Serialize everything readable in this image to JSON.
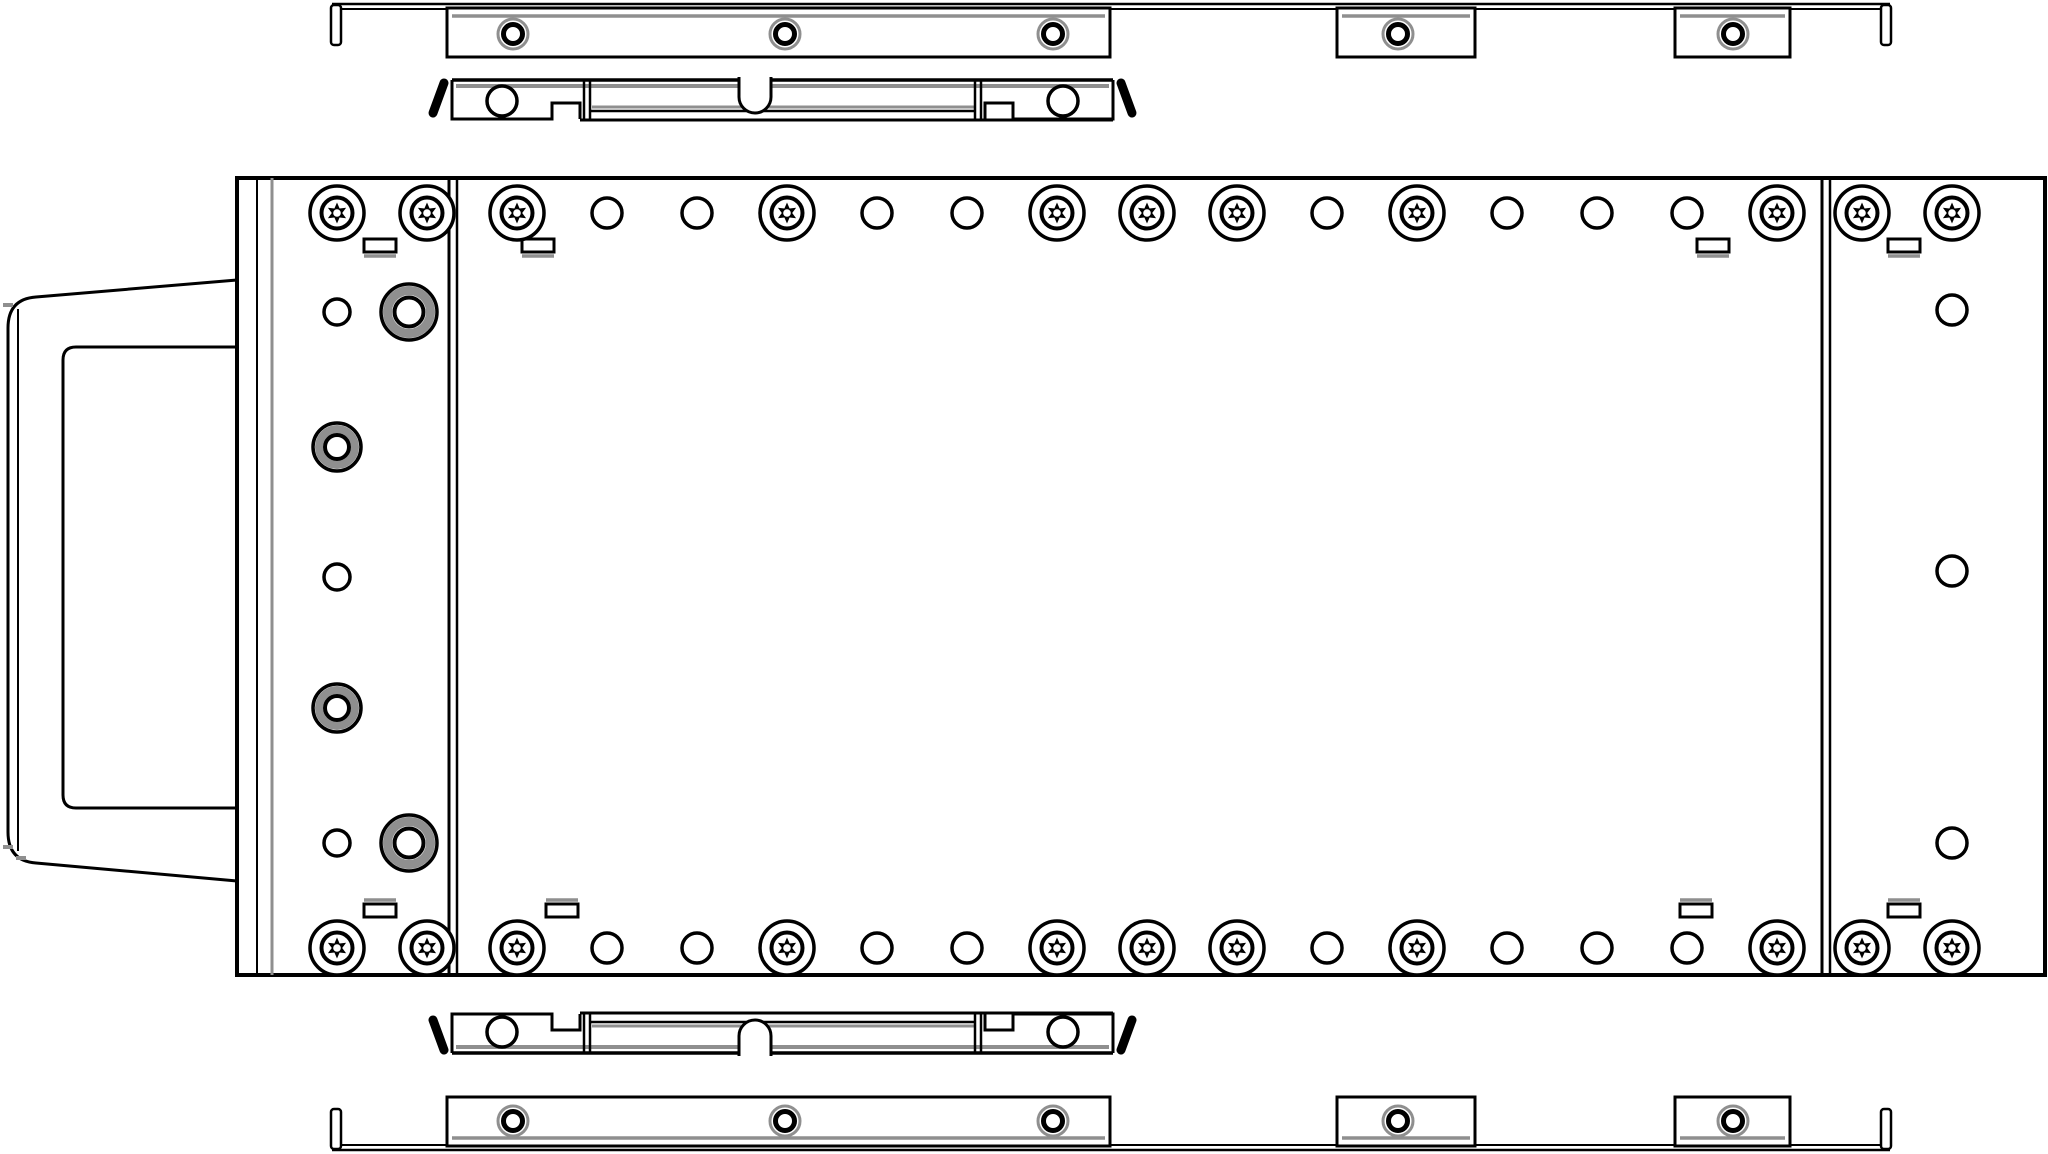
{
  "drawing": {
    "title": "hot-swap-drive-tray-exploded-side-view",
    "description": "Black-and-white engineering line drawing of a server drive tray/carrier body with handle, two latch brackets and two grommet mounting rails shown exploded above and below",
    "canvas": {
      "w": 2048,
      "h": 1154
    },
    "colors": {
      "line": "#000000",
      "gray": "#8f8f8f",
      "bg": "#ffffff"
    }
  },
  "parts": [
    {
      "name": "carrier-handle",
      "shapes": [
        {
          "t": "p",
          "d": "M237,280 L36,297 Q8,299 8,328 L8,832 Q8,861 36,863 L237,881",
          "sw": 3
        },
        {
          "t": "v",
          "x": 18,
          "y1": 309,
          "y2": 851,
          "sw": 2
        },
        {
          "t": "p",
          "d": "M237,347 L76,347 Q63,347 63,360 L63,795 Q63,808 76,808 L237,808",
          "sw": 3
        },
        {
          "t": "r",
          "x": 3,
          "y": 303,
          "w": 10,
          "h": 4,
          "sw": 0,
          "f": "#8f8f8f"
        },
        {
          "t": "r",
          "x": 3,
          "y": 845,
          "w": 10,
          "h": 4,
          "sw": 0,
          "f": "#8f8f8f"
        },
        {
          "t": "r",
          "x": 16,
          "y": 856,
          "w": 10,
          "h": 4,
          "sw": 0,
          "f": "#8f8f8f"
        }
      ]
    },
    {
      "name": "tray-body",
      "shapes": [
        {
          "t": "r",
          "x": 237,
          "y": 178,
          "w": 1808,
          "h": 797,
          "sw": 4,
          "f": "#ffffff"
        },
        {
          "t": "v",
          "x": 257,
          "y1": 178,
          "y2": 975,
          "sw": 2
        },
        {
          "t": "v",
          "x": 272,
          "y1": 178,
          "y2": 975,
          "sw": 3,
          "c": "y"
        },
        {
          "t": "v",
          "x": 449,
          "y1": 178,
          "y2": 975,
          "sw": 3
        },
        {
          "t": "v",
          "x": 457,
          "y1": 178,
          "y2": 975,
          "sw": 2.5
        },
        {
          "t": "v",
          "x": 1822,
          "y1": 178,
          "y2": 975,
          "sw": 3
        },
        {
          "t": "v",
          "x": 1830,
          "y1": 178,
          "y2": 975,
          "sw": 2.5
        },
        {
          "t": "s",
          "x": 364,
          "y": 239,
          "side": "b"
        },
        {
          "t": "s",
          "x": 522,
          "y": 239,
          "side": "b"
        },
        {
          "t": "s",
          "x": 1697,
          "y": 239,
          "side": "b"
        },
        {
          "t": "s",
          "x": 1888,
          "y": 239,
          "side": "b"
        },
        {
          "t": "s",
          "x": 364,
          "y": 904,
          "side": "t"
        },
        {
          "t": "s",
          "x": 546,
          "y": 904,
          "side": "t"
        },
        {
          "t": "s",
          "x": 1680,
          "y": 904,
          "side": "t"
        },
        {
          "t": "s",
          "x": 1888,
          "y": 904,
          "side": "t"
        },
        {
          "t": "t",
          "cx": 517,
          "cy": 213
        },
        {
          "t": "c",
          "cx": 607,
          "cy": 213,
          "r": 15,
          "sw": 3.5
        },
        {
          "t": "c",
          "cx": 697,
          "cy": 213,
          "r": 15,
          "sw": 3.5
        },
        {
          "t": "t",
          "cx": 787,
          "cy": 213
        },
        {
          "t": "c",
          "cx": 877,
          "cy": 213,
          "r": 15,
          "sw": 3.5
        },
        {
          "t": "c",
          "cx": 967,
          "cy": 213,
          "r": 15,
          "sw": 3.5
        },
        {
          "t": "t",
          "cx": 1057,
          "cy": 213
        },
        {
          "t": "t",
          "cx": 1147,
          "cy": 213
        },
        {
          "t": "t",
          "cx": 1237,
          "cy": 213
        },
        {
          "t": "c",
          "cx": 1327,
          "cy": 213,
          "r": 15,
          "sw": 3.5
        },
        {
          "t": "t",
          "cx": 1417,
          "cy": 213
        },
        {
          "t": "c",
          "cx": 1507,
          "cy": 213,
          "r": 15,
          "sw": 3.5
        },
        {
          "t": "c",
          "cx": 1597,
          "cy": 213,
          "r": 15,
          "sw": 3.5
        },
        {
          "t": "c",
          "cx": 1687,
          "cy": 213,
          "r": 15,
          "sw": 3.5
        },
        {
          "t": "t",
          "cx": 1777,
          "cy": 213
        },
        {
          "t": "t",
          "cx": 517,
          "cy": 948
        },
        {
          "t": "c",
          "cx": 607,
          "cy": 948,
          "r": 15,
          "sw": 3.5
        },
        {
          "t": "c",
          "cx": 697,
          "cy": 948,
          "r": 15,
          "sw": 3.5
        },
        {
          "t": "t",
          "cx": 787,
          "cy": 948
        },
        {
          "t": "c",
          "cx": 877,
          "cy": 948,
          "r": 15,
          "sw": 3.5
        },
        {
          "t": "c",
          "cx": 967,
          "cy": 948,
          "r": 15,
          "sw": 3.5
        },
        {
          "t": "t",
          "cx": 1057,
          "cy": 948
        },
        {
          "t": "t",
          "cx": 1147,
          "cy": 948
        },
        {
          "t": "t",
          "cx": 1237,
          "cy": 948
        },
        {
          "t": "c",
          "cx": 1327,
          "cy": 948,
          "r": 15,
          "sw": 3.5
        },
        {
          "t": "t",
          "cx": 1417,
          "cy": 948
        },
        {
          "t": "c",
          "cx": 1507,
          "cy": 948,
          "r": 15,
          "sw": 3.5
        },
        {
          "t": "c",
          "cx": 1597,
          "cy": 948,
          "r": 15,
          "sw": 3.5
        },
        {
          "t": "c",
          "cx": 1687,
          "cy": 948,
          "r": 15,
          "sw": 3.5
        },
        {
          "t": "t",
          "cx": 1777,
          "cy": 948
        },
        {
          "t": "t",
          "cx": 337,
          "cy": 213
        },
        {
          "t": "t",
          "cx": 427,
          "cy": 213
        },
        {
          "t": "c",
          "cx": 337,
          "cy": 312,
          "r": 13,
          "sw": 3.5
        },
        {
          "t": "G",
          "cx": 409,
          "cy": 312,
          "k": "lg"
        },
        {
          "t": "G",
          "cx": 337,
          "cy": 447,
          "k": "md"
        },
        {
          "t": "c",
          "cx": 337,
          "cy": 577,
          "r": 13,
          "sw": 3.5
        },
        {
          "t": "G",
          "cx": 337,
          "cy": 708,
          "k": "md"
        },
        {
          "t": "c",
          "cx": 337,
          "cy": 843,
          "r": 13,
          "sw": 3.5
        },
        {
          "t": "G",
          "cx": 409,
          "cy": 843,
          "k": "lg"
        },
        {
          "t": "t",
          "cx": 337,
          "cy": 948
        },
        {
          "t": "t",
          "cx": 427,
          "cy": 948
        },
        {
          "t": "t",
          "cx": 1862,
          "cy": 213
        },
        {
          "t": "t",
          "cx": 1952,
          "cy": 213
        },
        {
          "t": "c",
          "cx": 1952,
          "cy": 310,
          "r": 15,
          "sw": 3.5
        },
        {
          "t": "c",
          "cx": 1952,
          "cy": 571,
          "r": 15,
          "sw": 3.5
        },
        {
          "t": "c",
          "cx": 1952,
          "cy": 843,
          "r": 15,
          "sw": 3.5
        },
        {
          "t": "t",
          "cx": 1862,
          "cy": 948
        },
        {
          "t": "t",
          "cx": 1952,
          "cy": 948
        }
      ]
    },
    {
      "name": "top-mounting-rail",
      "shapes": [
        {
          "t": "h",
          "x1": 332,
          "x2": 1890,
          "y": 4,
          "sw": 2.5
        },
        {
          "t": "h",
          "x1": 332,
          "x2": 1890,
          "y": 9,
          "sw": 2
        },
        {
          "t": "r",
          "x": 331,
          "y": 5,
          "w": 10,
          "h": 40,
          "sw": 2.5,
          "rx": 3,
          "f": "#ffffff"
        },
        {
          "t": "r",
          "x": 1881,
          "y": 5,
          "w": 10,
          "h": 40,
          "sw": 2.5,
          "rx": 3,
          "f": "#ffffff"
        },
        {
          "t": "r",
          "x": 447,
          "y": 8,
          "w": 663,
          "h": 49,
          "sw": 3,
          "f": "#ffffff"
        },
        {
          "t": "r",
          "x": 1337,
          "y": 8,
          "w": 138,
          "h": 49,
          "sw": 3,
          "f": "#ffffff"
        },
        {
          "t": "r",
          "x": 1675,
          "y": 8,
          "w": 115,
          "h": 49,
          "sw": 3,
          "f": "#ffffff"
        },
        {
          "t": "h",
          "x1": 452,
          "x2": 1105,
          "y": 16,
          "sw": 3.5,
          "c": "y"
        },
        {
          "t": "h",
          "x1": 1342,
          "x2": 1470,
          "y": 16,
          "sw": 3.5,
          "c": "y"
        },
        {
          "t": "h",
          "x1": 1680,
          "x2": 1785,
          "y": 16,
          "sw": 3.5,
          "c": "y"
        },
        {
          "t": "g",
          "cx": 513,
          "cy": 34
        },
        {
          "t": "g",
          "cx": 785,
          "cy": 34
        },
        {
          "t": "g",
          "cx": 1053,
          "cy": 34
        },
        {
          "t": "g",
          "cx": 1398,
          "cy": 34
        },
        {
          "t": "g",
          "cx": 1733,
          "cy": 34
        }
      ]
    },
    {
      "name": "top-latch-bracket",
      "shapes": [
        {
          "t": "l",
          "x1": 444,
          "y1": 83,
          "x2": 433,
          "y2": 113,
          "sw": 9,
          "cap": "round"
        },
        {
          "t": "l",
          "x1": 1121,
          "y1": 83,
          "x2": 1132,
          "y2": 113,
          "sw": 9,
          "cap": "round"
        },
        {
          "t": "h",
          "x1": 452,
          "x2": 1113,
          "y": 80,
          "sw": 3.5
        },
        {
          "t": "h",
          "x1": 456,
          "x2": 1109,
          "y": 86,
          "sw": 4,
          "c": "y"
        },
        {
          "t": "h",
          "x1": 580,
          "x2": 1113,
          "y": 120,
          "sw": 3
        },
        {
          "t": "h",
          "x1": 590,
          "x2": 976,
          "y": 111,
          "sw": 2.5
        },
        {
          "t": "h",
          "x1": 592,
          "x2": 974,
          "y": 107,
          "sw": 3,
          "c": "y"
        },
        {
          "t": "p",
          "d": "M452,80 L452,119 L552,119 L552,103 L580,103 L580,119",
          "sw": 3
        },
        {
          "t": "p",
          "d": "M1113,80 L1113,119 L1013,119 L1013,103 L985,103 L985,119",
          "sw": 3
        },
        {
          "t": "v",
          "x": 584,
          "y1": 80,
          "y2": 119,
          "sw": 2.5
        },
        {
          "t": "v",
          "x": 590,
          "y1": 80,
          "y2": 119,
          "sw": 2.5
        },
        {
          "t": "v",
          "x": 975,
          "y1": 80,
          "y2": 119,
          "sw": 2.5
        },
        {
          "t": "v",
          "x": 981,
          "y1": 80,
          "y2": 119,
          "sw": 2.5
        },
        {
          "t": "p",
          "d": "M739,77 L739,97 A16 16 0 0 0 771,97 L771,77",
          "sw": 3,
          "f": "#ffffff"
        },
        {
          "t": "c",
          "cx": 502,
          "cy": 101,
          "r": 15,
          "sw": 3.5
        },
        {
          "t": "c",
          "cx": 1063,
          "cy": 101,
          "r": 15,
          "sw": 3.5
        }
      ]
    },
    {
      "name": "bottom-latch-bracket",
      "shapes": [
        {
          "t": "l",
          "x1": 444,
          "y1": 1050,
          "x2": 433,
          "y2": 1020,
          "sw": 9,
          "cap": "round"
        },
        {
          "t": "l",
          "x1": 1121,
          "y1": 1050,
          "x2": 1132,
          "y2": 1020,
          "sw": 9,
          "cap": "round"
        },
        {
          "t": "h",
          "x1": 452,
          "x2": 1113,
          "y": 1053,
          "sw": 3.5
        },
        {
          "t": "h",
          "x1": 456,
          "x2": 1109,
          "y": 1047,
          "sw": 4,
          "c": "y"
        },
        {
          "t": "h",
          "x1": 580,
          "x2": 1113,
          "y": 1013,
          "sw": 3
        },
        {
          "t": "h",
          "x1": 590,
          "x2": 976,
          "y": 1022,
          "sw": 2.5
        },
        {
          "t": "h",
          "x1": 592,
          "x2": 974,
          "y": 1026,
          "sw": 3,
          "c": "y"
        },
        {
          "t": "p",
          "d": "M452,1053 L452,1014 L552,1014 L552,1030 L580,1030 L580,1014",
          "sw": 3
        },
        {
          "t": "p",
          "d": "M1113,1053 L1113,1014 L1013,1014 L1013,1030 L985,1030 L985,1014",
          "sw": 3
        },
        {
          "t": "v",
          "x": 584,
          "y1": 1014,
          "y2": 1053,
          "sw": 2.5
        },
        {
          "t": "v",
          "x": 590,
          "y1": 1014,
          "y2": 1053,
          "sw": 2.5
        },
        {
          "t": "v",
          "x": 975,
          "y1": 1014,
          "y2": 1053,
          "sw": 2.5
        },
        {
          "t": "v",
          "x": 981,
          "y1": 1014,
          "y2": 1053,
          "sw": 2.5
        },
        {
          "t": "p",
          "d": "M739,1056 L739,1036 A16 16 0 0 1 771,1036 L771,1056",
          "sw": 3,
          "f": "#ffffff"
        },
        {
          "t": "c",
          "cx": 502,
          "cy": 1032,
          "r": 15,
          "sw": 3.5
        },
        {
          "t": "c",
          "cx": 1063,
          "cy": 1032,
          "r": 15,
          "sw": 3.5
        }
      ]
    },
    {
      "name": "bottom-mounting-rail",
      "shapes": [
        {
          "t": "h",
          "x1": 332,
          "x2": 1890,
          "y": 1150,
          "sw": 2.5
        },
        {
          "t": "h",
          "x1": 332,
          "x2": 1890,
          "y": 1145,
          "sw": 2
        },
        {
          "t": "r",
          "x": 331,
          "y": 1109,
          "w": 10,
          "h": 40,
          "sw": 2.5,
          "rx": 3,
          "f": "#ffffff"
        },
        {
          "t": "r",
          "x": 1881,
          "y": 1109,
          "w": 10,
          "h": 40,
          "sw": 2.5,
          "rx": 3,
          "f": "#ffffff"
        },
        {
          "t": "r",
          "x": 447,
          "y": 1097,
          "w": 663,
          "h": 49,
          "sw": 3,
          "f": "#ffffff"
        },
        {
          "t": "r",
          "x": 1337,
          "y": 1097,
          "w": 138,
          "h": 49,
          "sw": 3,
          "f": "#ffffff"
        },
        {
          "t": "r",
          "x": 1675,
          "y": 1097,
          "w": 115,
          "h": 49,
          "sw": 3,
          "f": "#ffffff"
        },
        {
          "t": "h",
          "x1": 452,
          "x2": 1105,
          "y": 1138,
          "sw": 3.5,
          "c": "y"
        },
        {
          "t": "h",
          "x1": 1342,
          "x2": 1470,
          "y": 1138,
          "sw": 3.5,
          "c": "y"
        },
        {
          "t": "h",
          "x1": 1680,
          "x2": 1785,
          "y": 1138,
          "sw": 3.5,
          "c": "y"
        },
        {
          "t": "g",
          "cx": 513,
          "cy": 1121
        },
        {
          "t": "g",
          "cx": 785,
          "cy": 1121
        },
        {
          "t": "g",
          "cx": 1053,
          "cy": 1121
        },
        {
          "t": "g",
          "cx": 1398,
          "cy": 1121
        },
        {
          "t": "g",
          "cx": 1733,
          "cy": 1121
        }
      ]
    }
  ]
}
